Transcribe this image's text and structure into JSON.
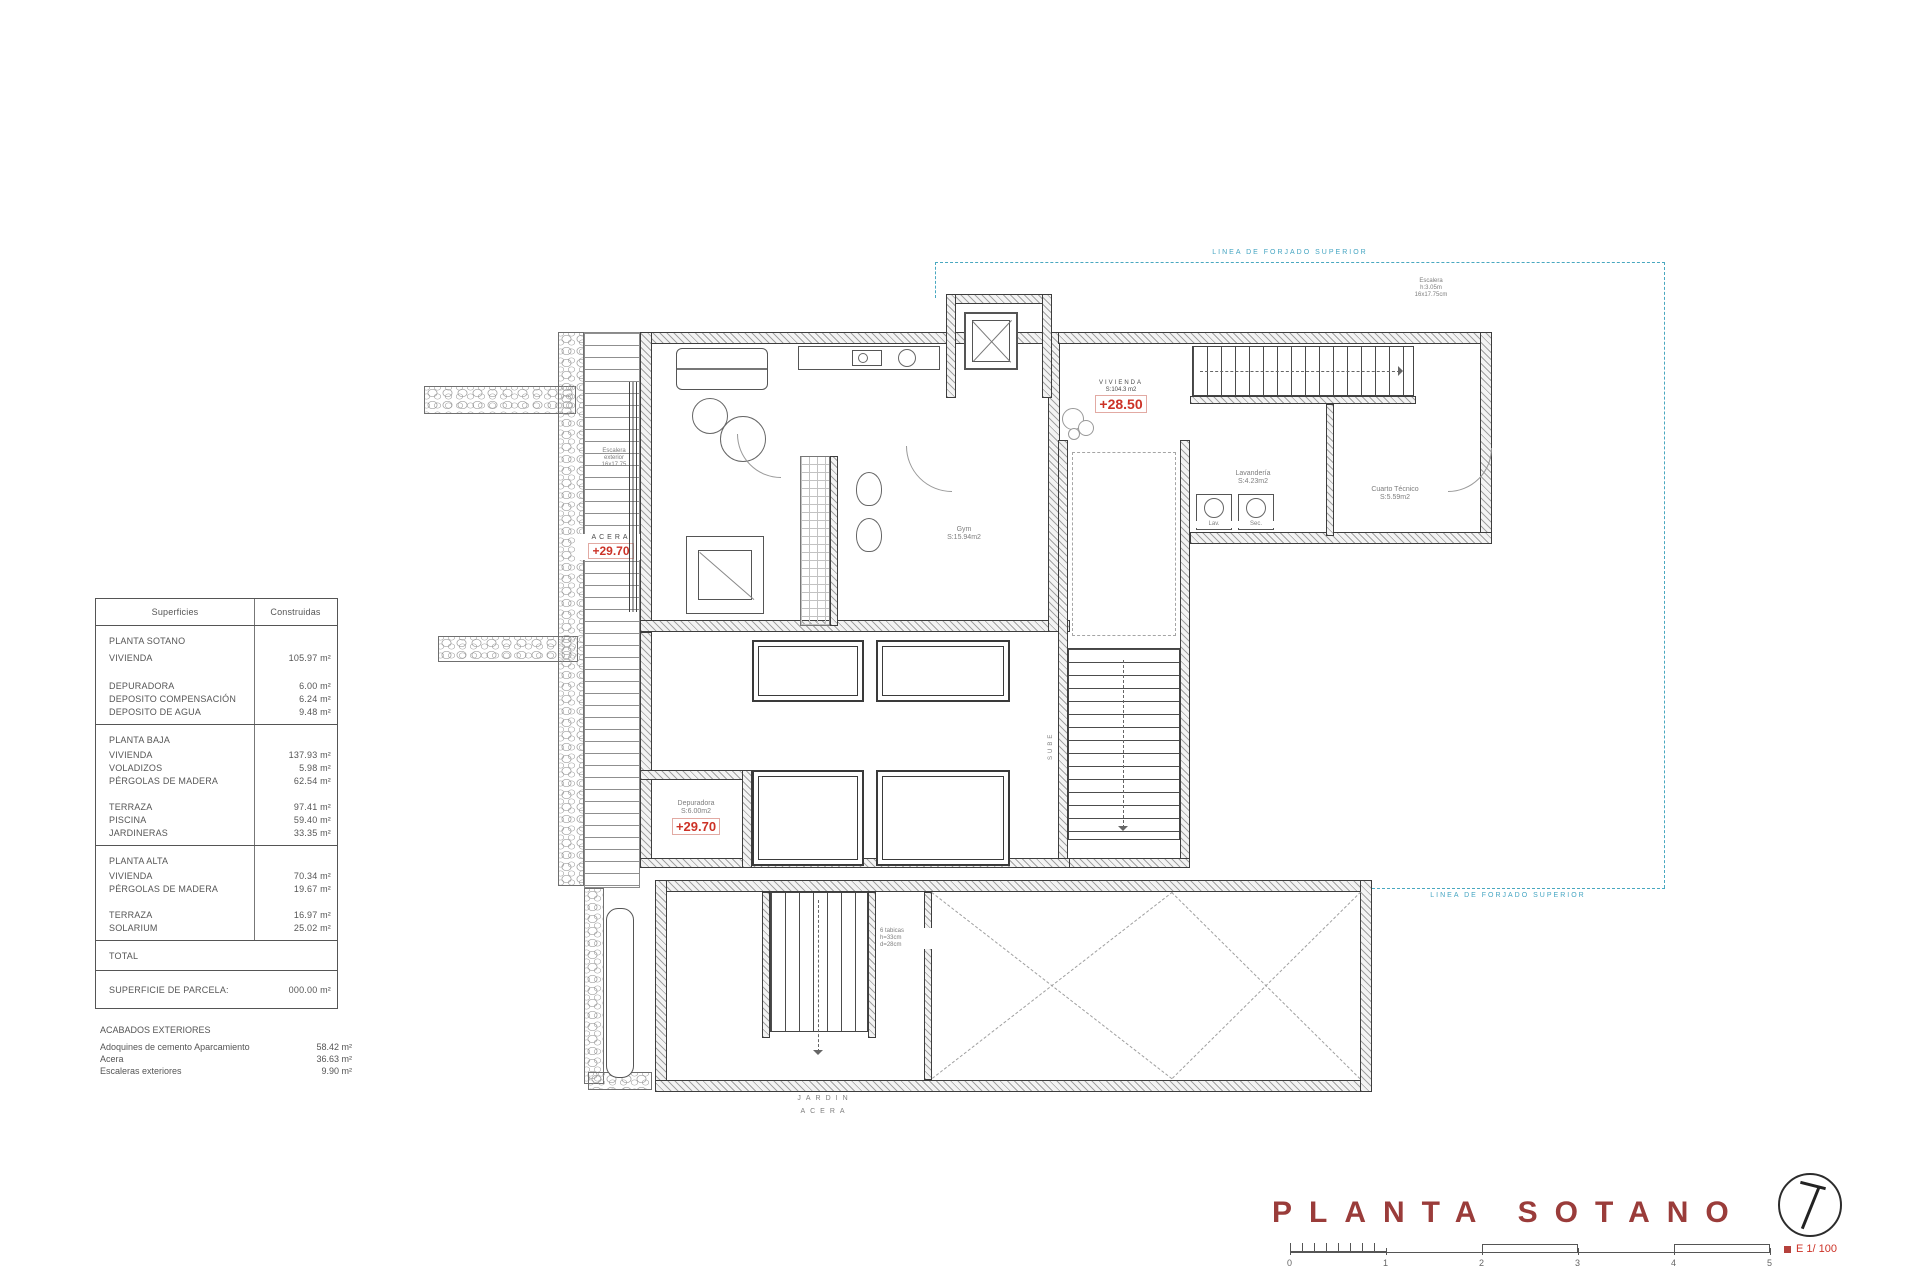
{
  "colors": {
    "accent_red": "#cc3227",
    "title_red": "#9a3c3a",
    "cyan": "#45a5c2",
    "wall": "#3d3d3d"
  },
  "surfaces_table": {
    "header": {
      "left": "Superficies",
      "right": "Construidas"
    },
    "rows": [
      {
        "label": "PLANTA SOTANO",
        "value": ""
      },
      {
        "label": "VIVIENDA",
        "value": "105.97 m²"
      },
      {
        "label": "DEPURADORA",
        "value": "6.00 m²"
      },
      {
        "label": "DEPOSITO COMPENSACIÓN",
        "value": "6.24 m²"
      },
      {
        "label": "DEPOSITO DE AGUA",
        "value": "9.48 m²"
      },
      {
        "label": "PLANTA BAJA",
        "value": ""
      },
      {
        "label": "VIVIENDA",
        "value": "137.93 m²"
      },
      {
        "label": "VOLADIZOS",
        "value": "5.98 m²"
      },
      {
        "label": "PÉRGOLAS DE MADERA",
        "value": "62.54 m²"
      },
      {
        "label": "TERRAZA",
        "value": "97.41 m²"
      },
      {
        "label": "PISCINA",
        "value": "59.40 m²"
      },
      {
        "label": "JARDINERAS",
        "value": "33.35 m²"
      },
      {
        "label": "PLANTA ALTA",
        "value": ""
      },
      {
        "label": "VIVIENDA",
        "value": "70.34 m²"
      },
      {
        "label": "PÉRGOLAS DE MADERA",
        "value": "19.67 m²"
      },
      {
        "label": "TERRAZA",
        "value": "16.97 m²"
      },
      {
        "label": "SOLARIUM",
        "value": "25.02 m²"
      },
      {
        "label": "TOTAL",
        "value": ""
      },
      {
        "label": "SUPERFICIE DE PARCELA:",
        "value": "000.00 m²"
      }
    ]
  },
  "acabados": {
    "title": "ACABADOS EXTERIORES",
    "rows": [
      {
        "label": "Adoquines de cemento Aparcamiento",
        "value": "58.42 m²"
      },
      {
        "label": "Acera",
        "value": "36.63 m²"
      },
      {
        "label": "Escaleras exteriores",
        "value": "9.90 m²"
      }
    ]
  },
  "plan": {
    "forjado_label_top": "LINEA DE FORJADO SUPERIOR",
    "forjado_label_bottom": "LINEA DE FORJADO SUPERIOR",
    "vivienda": {
      "name": "VIVIENDA",
      "area": "S:104.3 m2",
      "level": "+28.50"
    },
    "acera": {
      "name": "ACERA",
      "level": "+29.70"
    },
    "depuradora": {
      "name": "Depuradora",
      "area": "S:6.00m2",
      "level": "+29.70"
    },
    "gym": {
      "name": "Gym",
      "area": "S:15.94m2"
    },
    "lavanderia": {
      "name": "Lavandería",
      "area": "S:4.23m2"
    },
    "cuarto_tecnico": {
      "name": "Cuarto Técnico",
      "area": "S:5.59m2"
    },
    "lav": "Lav.",
    "sec": "Sec.",
    "stair_note": {
      "l1": "Escalera",
      "l2": "h:3.05m",
      "l3": "16x17.75cm"
    },
    "exterior_stair_note": {
      "l1": "Escalera",
      "l2": "exterior",
      "l3": "16x17.75"
    },
    "ramp_note": {
      "l1": "6 tabicas",
      "l2": "h=33cm",
      "l3": "d=28cm"
    },
    "sube": "SUBE",
    "bottom_labels": {
      "jardin": "JARDIN",
      "acera": "ACERA"
    }
  },
  "title_block": {
    "title": "PLANTA SOTANO",
    "scale": "E 1/ 100",
    "ticks": [
      "0",
      "1",
      "2",
      "3",
      "4",
      "5"
    ]
  }
}
